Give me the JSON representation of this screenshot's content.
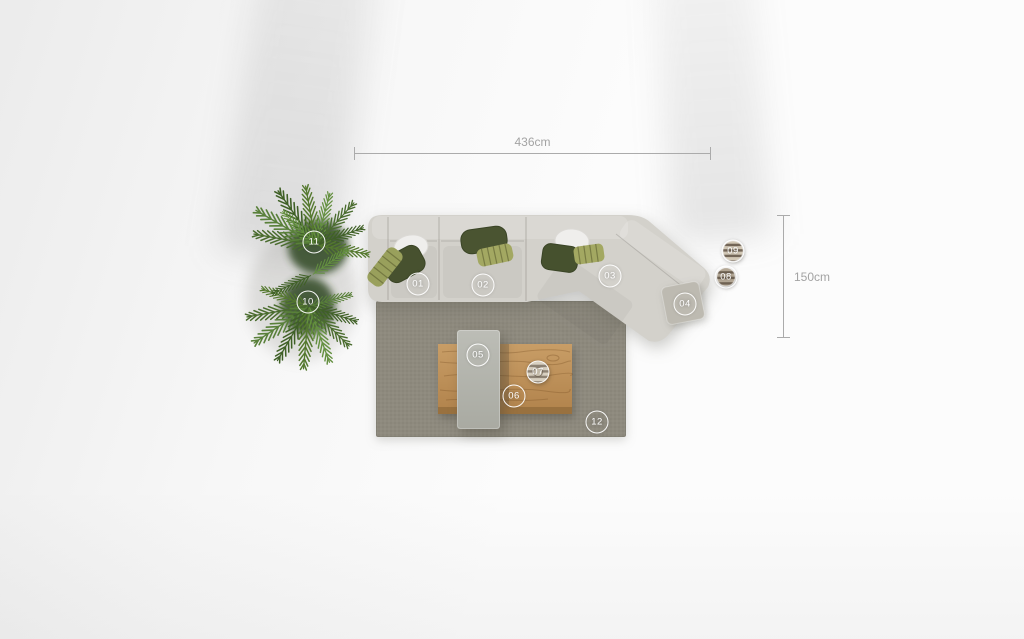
{
  "annotations": {
    "dimensions": {
      "horizontal_label": "436cm",
      "vertical_label": "150cm"
    },
    "markers": {
      "m01": "01",
      "m02": "02",
      "m03": "03",
      "m04": "04",
      "m05": "05",
      "m06": "06",
      "m07": "07",
      "m08": "08",
      "m09": "09",
      "m10": "10",
      "m11": "11",
      "m12": "12"
    }
  },
  "colors": {
    "background": "#fcfcfc",
    "sofa_fabric": "#d3d1cb",
    "rug": "#8e8a7e",
    "wood_table": "#c1965e",
    "concrete_table": "#b7b8b0",
    "ottoman_table": "#bdbab1",
    "pillow_dark_green": "#4a5431",
    "pillow_olive": "#a3a862",
    "pillow_white": "#efeeec",
    "plant_green": "#4a6c2e",
    "pouf_stripe": "#483a2c",
    "marker_text": "#ffffff",
    "dimension_line": "#a6a6a6"
  }
}
